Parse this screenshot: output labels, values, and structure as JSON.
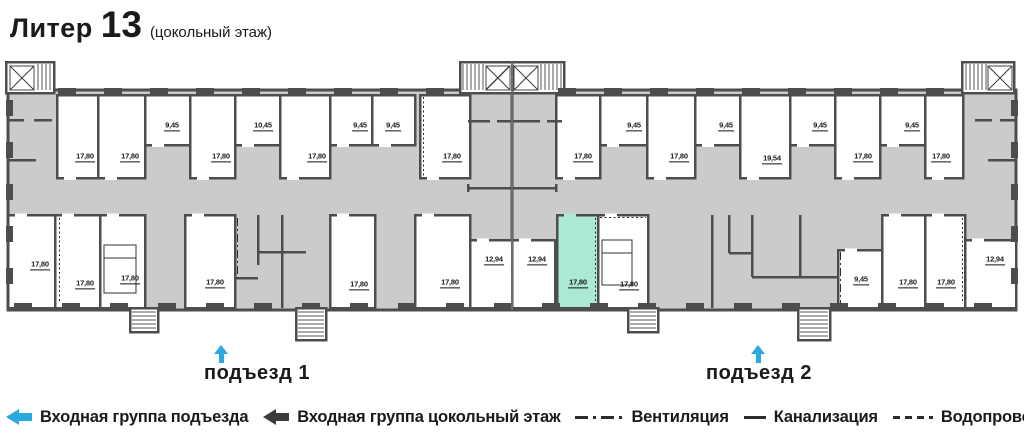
{
  "title": {
    "liter": "Литер",
    "number": "13",
    "floor": "(цокольный этаж)"
  },
  "colors": {
    "accent": "#29a9e0",
    "wall": "#4d4d4d",
    "common_area": "#cbcbcb",
    "highlight_room": "#abe8d5"
  },
  "entrances": [
    {
      "label": "подъезд 1"
    },
    {
      "label": "подъезд 2"
    }
  ],
  "legend": [
    {
      "icon": "arrow-cyan-left",
      "label": "Входная группа подъезда"
    },
    {
      "icon": "arrow-dark-left",
      "label": "Входная группа цокольный этаж"
    },
    {
      "icon": "line-dashdot",
      "label": "Вентиляция"
    },
    {
      "icon": "line-solid",
      "label": "Канализация"
    },
    {
      "icon": "line-dashed",
      "label": "Водопровод"
    }
  ],
  "plan": {
    "rooms": [
      {
        "label": "17,80",
        "x": 57,
        "y": 95,
        "w": 41,
        "h": 83,
        "lx": 85,
        "ly": 162
      },
      {
        "label": "17,80",
        "x": 98,
        "y": 95,
        "w": 47,
        "h": 83,
        "lx": 130,
        "ly": 162
      },
      {
        "label": "9,45",
        "x": 145,
        "y": 95,
        "w": 45,
        "h": 50,
        "lx": 172,
        "ly": 131
      },
      {
        "label": "17,80",
        "x": 190,
        "y": 95,
        "w": 45,
        "h": 83,
        "lx": 221,
        "ly": 162
      },
      {
        "label": "10,45",
        "x": 235,
        "y": 95,
        "w": 45,
        "h": 50,
        "lx": 263,
        "ly": 131
      },
      {
        "label": "17,80",
        "x": 280,
        "y": 95,
        "w": 50,
        "h": 83,
        "lx": 317,
        "ly": 162
      },
      {
        "label": "9,45",
        "x": 330,
        "y": 95,
        "w": 42,
        "h": 50,
        "lx": 360,
        "ly": 131
      },
      {
        "label": "9,45",
        "x": 372,
        "y": 95,
        "w": 43,
        "h": 50,
        "lx": 393,
        "ly": 131
      },
      {
        "label": "17,80",
        "x": 420,
        "y": 95,
        "w": 50,
        "h": 83,
        "lx": 452,
        "ly": 162
      },
      {
        "label": "17,80",
        "x": 556,
        "y": 95,
        "w": 44,
        "h": 83,
        "lx": 583,
        "ly": 162
      },
      {
        "label": "9,45",
        "x": 600,
        "y": 95,
        "w": 47,
        "h": 50,
        "lx": 634,
        "ly": 131
      },
      {
        "label": "17,80",
        "x": 647,
        "y": 95,
        "w": 48,
        "h": 83,
        "lx": 679,
        "ly": 162
      },
      {
        "label": "9,45",
        "x": 695,
        "y": 95,
        "w": 45,
        "h": 50,
        "lx": 726,
        "ly": 131
      },
      {
        "label": "19,54",
        "x": 740,
        "y": 95,
        "w": 50,
        "h": 83,
        "lx": 772,
        "ly": 164
      },
      {
        "label": "9,45",
        "x": 790,
        "y": 95,
        "w": 45,
        "h": 50,
        "lx": 820,
        "ly": 131
      },
      {
        "label": "17,80",
        "x": 835,
        "y": 95,
        "w": 45,
        "h": 83,
        "lx": 863,
        "ly": 162
      },
      {
        "label": "9,45",
        "x": 880,
        "y": 95,
        "w": 45,
        "h": 50,
        "lx": 912,
        "ly": 131
      },
      {
        "label": "17,80",
        "x": 925,
        "y": 95,
        "w": 38,
        "h": 83,
        "lx": 941,
        "ly": 162
      },
      {
        "label": "17,80",
        "x": 8,
        "y": 215,
        "w": 47,
        "h": 93,
        "lx": 40,
        "ly": 270
      },
      {
        "label": "17,80",
        "x": 55,
        "y": 215,
        "w": 45,
        "h": 93,
        "lx": 85,
        "ly": 289
      },
      {
        "label": "17,80",
        "x": 100,
        "y": 215,
        "w": 45,
        "h": 93,
        "lx": 130,
        "ly": 284
      },
      {
        "label": "17,80",
        "x": 185,
        "y": 215,
        "w": 50,
        "h": 93,
        "lx": 215,
        "ly": 288
      },
      {
        "label": "17,80",
        "x": 330,
        "y": 215,
        "w": 45,
        "h": 93,
        "lx": 359,
        "ly": 290
      },
      {
        "label": "17,80",
        "x": 415,
        "y": 215,
        "w": 55,
        "h": 93,
        "lx": 450,
        "ly": 288
      },
      {
        "label": "12,94",
        "x": 470,
        "y": 240,
        "w": 42,
        "h": 68,
        "lx": 494,
        "ly": 265
      },
      {
        "label": "12,94",
        "x": 512,
        "y": 240,
        "w": 43,
        "h": 68,
        "lx": 537,
        "ly": 265
      },
      {
        "label": "17,80",
        "x": 557,
        "y": 215,
        "w": 41,
        "h": 93,
        "lx": 578,
        "ly": 288,
        "highlight": true
      },
      {
        "label": "17,80",
        "x": 598,
        "y": 215,
        "w": 50,
        "h": 93,
        "lx": 629,
        "ly": 290
      },
      {
        "label": "9,45",
        "x": 838,
        "y": 250,
        "w": 44,
        "h": 58,
        "lx": 861,
        "ly": 285
      },
      {
        "label": "17,80",
        "x": 882,
        "y": 215,
        "w": 43,
        "h": 93,
        "lx": 908,
        "ly": 288
      },
      {
        "label": "17,80",
        "x": 925,
        "y": 215,
        "w": 40,
        "h": 93,
        "lx": 946,
        "ly": 288
      },
      {
        "label": "12,94",
        "x": 965,
        "y": 240,
        "w": 51,
        "h": 68,
        "lx": 995,
        "ly": 265
      }
    ]
  }
}
